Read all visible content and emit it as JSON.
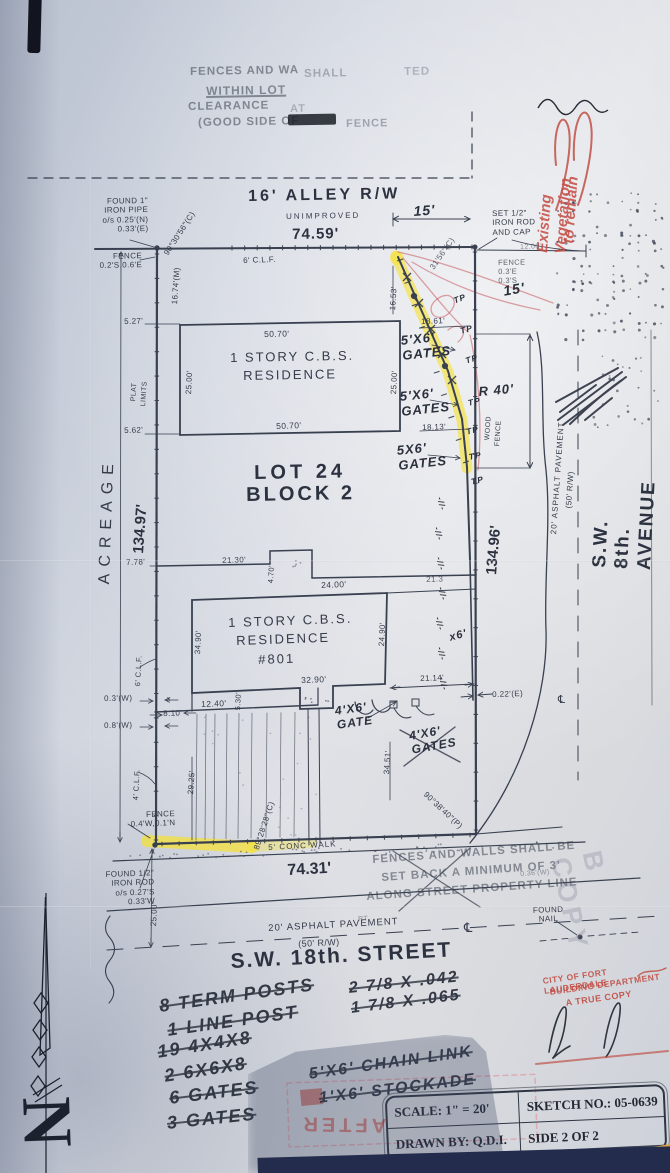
{
  "compass": {
    "letter": "N"
  },
  "title_block": {
    "scale": "SCALE: 1\" = 20'",
    "drawn_by": "DRAWN BY: Q.D.I.",
    "sketch_no": "SKETCH NO.: 05-0639",
    "side": "SIDE 2 OF 2"
  },
  "colors": {
    "paper": "#dfe1e6",
    "ink": "#394050",
    "highlight": "#f7e12d",
    "red_ink": "#c2463c",
    "shadow_navy": "#232c4c",
    "corner_orange": "#dfa245"
  },
  "labels": [
    {
      "n": "top-stamp-line1a",
      "t": "FENCES AND WA",
      "x": 190,
      "y": 66,
      "r": -1,
      "s": 11.5,
      "c": "stamp"
    },
    {
      "n": "top-stamp-line1b",
      "t": "SHALL",
      "x": 304,
      "y": 68,
      "r": -1,
      "s": 11.5,
      "c": "stamp",
      "o": 0.35
    },
    {
      "n": "top-stamp-line1c",
      "t": "TED",
      "x": 404,
      "y": 66,
      "r": -1,
      "s": 11.5,
      "c": "stamp",
      "o": 0.3
    },
    {
      "n": "top-stamp-line2",
      "t": "WITHIN LOT",
      "x": 206,
      "y": 84,
      "r": -1,
      "s": 12,
      "c": "stamp u"
    },
    {
      "n": "top-stamp-line3",
      "t": "CLEARANCE",
      "x": 188,
      "y": 101,
      "r": -1,
      "s": 11.5,
      "c": "stamp"
    },
    {
      "n": "top-stamp-line3b",
      "t": "AT",
      "x": 290,
      "y": 103,
      "r": -1,
      "s": 11,
      "c": "stamp",
      "o": 0.3
    },
    {
      "n": "top-stamp-line4a",
      "t": "(GOOD SIDE OF",
      "x": 198,
      "y": 117,
      "r": -1,
      "s": 11.5,
      "c": "stamp"
    },
    {
      "n": "top-stamp-line4b",
      "t": "FENCE",
      "x": 346,
      "y": 118,
      "r": -1,
      "s": 11,
      "c": "stamp",
      "o": 0.4
    },
    {
      "n": "red-note-existing-vegetation",
      "t": "Existing Vegetation",
      "x": 534,
      "y": 252,
      "r": -86,
      "s": 15,
      "c": "redhand"
    },
    {
      "n": "red-note-to-remain",
      "t": "to remain",
      "x": 560,
      "y": 243,
      "r": -86,
      "s": 15,
      "c": "redhand"
    },
    {
      "n": "alley-title",
      "t": "16' ALLEY R/W",
      "x": 248,
      "y": 188,
      "r": -1,
      "s": 16,
      "c": "big",
      "ls": 3
    },
    {
      "n": "alley-unimproved",
      "t": "UNIMPROVED",
      "x": 286,
      "y": 212,
      "r": -1,
      "s": 8,
      "c": "tech",
      "ls": 2
    },
    {
      "n": "alley-dim-7459",
      "t": "74.59'",
      "x": 292,
      "y": 226,
      "r": -1,
      "s": 15,
      "c": "big",
      "ls": 1
    },
    {
      "n": "found-pipe-note",
      "t": "FOUND 1\"\nIRON PIPE\no/s 0.25'(N)\n0.33'(E)",
      "x": 88,
      "y": 197,
      "r": -1,
      "s": 8,
      "c": "tech",
      "w": 60,
      "ta": "right"
    },
    {
      "n": "fence-note-nw",
      "t": "FENCE\n0.2'S,0.6'E",
      "x": 94,
      "y": 252,
      "r": -1,
      "s": 8,
      "c": "tech",
      "w": 48,
      "ta": "right"
    },
    {
      "n": "angle-nw",
      "t": "90°30'56\"(C)",
      "x": 162,
      "y": 252,
      "r": -57,
      "s": 8,
      "c": "tech"
    },
    {
      "n": "dim-1674",
      "t": "16.74'(M)",
      "x": 170,
      "y": 304,
      "r": -86,
      "s": 8,
      "c": "tech"
    },
    {
      "n": "clf-north",
      "t": "6' C.L.F.",
      "x": 243,
      "y": 256,
      "r": -2,
      "s": 8,
      "c": "tech"
    },
    {
      "n": "dim-15-alley",
      "t": "15'",
      "x": 413,
      "y": 203,
      "r": -4,
      "s": 14,
      "c": "hand"
    },
    {
      "n": "set-rod-note",
      "t": "SET 1/2\"\nIRON ROD\nAND CAP",
      "x": 492,
      "y": 209,
      "r": -1,
      "s": 8,
      "c": "tech"
    },
    {
      "n": "dim-1200",
      "t": "12.00'",
      "x": 520,
      "y": 244,
      "r": -2,
      "s": 7,
      "c": "tech",
      "o": 0.55
    },
    {
      "n": "fence-note-ne",
      "t": "FENCE\n0.3'E\n0.3'S",
      "x": 498,
      "y": 259,
      "r": -1,
      "s": 7.5,
      "c": "tech",
      "o": 0.8
    },
    {
      "n": "hand-15",
      "t": "15'",
      "x": 502,
      "y": 283,
      "r": -10,
      "s": 14,
      "c": "hand"
    },
    {
      "n": "angle-ne",
      "t": "31'56\"(C)",
      "x": 428,
      "y": 266,
      "r": -55,
      "s": 8,
      "c": "tech",
      "o": 0.8
    },
    {
      "n": "dim-1653",
      "t": "16.53'",
      "x": 388,
      "y": 310,
      "r": -86,
      "s": 8,
      "c": "tech"
    },
    {
      "n": "dim-1861",
      "t": "18.61'",
      "x": 421,
      "y": 317,
      "r": -2,
      "s": 8,
      "c": "tech"
    },
    {
      "n": "gate-label-1",
      "t": "5'X6'\nGATES",
      "x": 400,
      "y": 333,
      "r": -6,
      "s": 13,
      "c": "hand"
    },
    {
      "n": "gate-label-2",
      "t": "5'X6'\nGATES",
      "x": 399,
      "y": 389,
      "r": -6,
      "s": 13,
      "c": "hand"
    },
    {
      "n": "gate-label-3",
      "t": "5X6'\nGATES",
      "x": 396,
      "y": 443,
      "r": -6,
      "s": 13,
      "c": "hand"
    },
    {
      "n": "hand-r40",
      "t": "R 40'",
      "x": 478,
      "y": 384,
      "r": -5,
      "s": 13,
      "c": "hand"
    },
    {
      "n": "wood-fence-label-1",
      "t": "WOOD",
      "x": 484,
      "y": 440,
      "r": -86,
      "s": 7,
      "c": "tech"
    },
    {
      "n": "wood-fence-label-2",
      "t": "FENCE",
      "x": 494,
      "y": 446,
      "r": -86,
      "s": 7,
      "c": "tech"
    },
    {
      "n": "dim-1813",
      "t": "18.13'",
      "x": 422,
      "y": 423,
      "r": -2,
      "s": 8,
      "c": "tech"
    },
    {
      "n": "tp-mark-a",
      "t": "TP",
      "x": 452,
      "y": 296,
      "r": -20,
      "s": 8.5,
      "c": "hand"
    },
    {
      "n": "tp-mark-b",
      "t": "TP",
      "x": 459,
      "y": 326,
      "r": -15,
      "s": 8.5,
      "c": "hand"
    },
    {
      "n": "tp-mark-c",
      "t": "TP",
      "x": 464,
      "y": 356,
      "r": -18,
      "s": 8.5,
      "c": "hand"
    },
    {
      "n": "tp-mark-d",
      "t": "TP",
      "x": 467,
      "y": 398,
      "r": -12,
      "s": 8.5,
      "c": "hand"
    },
    {
      "n": "tp-mark-e",
      "t": "TP",
      "x": 465,
      "y": 427,
      "r": -15,
      "s": 8.5,
      "c": "hand"
    },
    {
      "n": "tp-mark-f",
      "t": "TP",
      "x": 468,
      "y": 452,
      "r": -10,
      "s": 8.5,
      "c": "hand"
    },
    {
      "n": "tp-mark-g",
      "t": "TP",
      "x": 470,
      "y": 477,
      "r": -14,
      "s": 8.5,
      "c": "hand"
    },
    {
      "n": "avenue-name",
      "t": "S.W. 8th. AVENUE",
      "x": 589,
      "y": 567,
      "r": -87,
      "s": 19,
      "c": "big",
      "ls": 2
    },
    {
      "n": "avenue-pavement",
      "t": "20' ASPHALT PAVEMENT",
      "x": 549,
      "y": 534,
      "r": -86,
      "s": 8,
      "c": "tech",
      "ls": 1
    },
    {
      "n": "avenue-rw",
      "t": "(50' R/W)",
      "x": 564,
      "y": 508,
      "r": -86,
      "s": 8,
      "c": "tech"
    },
    {
      "n": "dim-13496",
      "t": "134.96'",
      "x": 483,
      "y": 574,
      "r": -85,
      "s": 15,
      "c": "big"
    },
    {
      "n": "dim-022e",
      "t": "0.22'(E)",
      "x": 492,
      "y": 690,
      "r": -2,
      "s": 8,
      "c": "tech"
    },
    {
      "n": "dim-2114",
      "t": "21.14'",
      "x": 420,
      "y": 674,
      "r": -2,
      "s": 8,
      "c": "tech"
    },
    {
      "n": "hand-x6",
      "t": "x6'",
      "x": 448,
      "y": 632,
      "r": -15,
      "s": 11,
      "c": "hand"
    },
    {
      "n": "hash-mark-1",
      "t": "-//-",
      "x": 444,
      "y": 496,
      "r": 75,
      "s": 8,
      "c": "hand"
    },
    {
      "n": "hash-mark-2",
      "t": "-//-",
      "x": 441,
      "y": 526,
      "r": 75,
      "s": 8,
      "c": "hand"
    },
    {
      "n": "hash-mark-3",
      "t": "-//-",
      "x": 443,
      "y": 556,
      "r": 75,
      "s": 8,
      "c": "hand"
    },
    {
      "n": "hash-mark-4",
      "t": "-//-",
      "x": 445,
      "y": 586,
      "r": 75,
      "s": 8,
      "c": "hand"
    },
    {
      "n": "hash-mark-5",
      "t": "-//-",
      "x": 442,
      "y": 616,
      "r": 75,
      "s": 8,
      "c": "hand"
    },
    {
      "n": "hash-mark-6",
      "t": "-//-",
      "x": 444,
      "y": 646,
      "r": 75,
      "s": 8,
      "c": "hand"
    },
    {
      "n": "hash-mark-7",
      "t": "-//-",
      "x": 446,
      "y": 676,
      "r": 75,
      "s": 8,
      "c": "hand"
    },
    {
      "n": "lot-title",
      "t": "LOT 24",
      "x": 254,
      "y": 462,
      "r": -1,
      "s": 20,
      "c": "big",
      "ls": 4
    },
    {
      "n": "block-title",
      "t": "BLOCK 2",
      "x": 246,
      "y": 484,
      "r": -1,
      "s": 20,
      "c": "big",
      "ls": 3
    },
    {
      "n": "acreage-label",
      "t": "ACREAGE",
      "x": 96,
      "y": 584,
      "r": -88,
      "s": 16,
      "c": "tech",
      "ls": 7
    },
    {
      "n": "dim-13497",
      "t": "134.97'",
      "x": 130,
      "y": 553,
      "r": -86,
      "s": 15,
      "c": "big"
    },
    {
      "n": "plat-label",
      "t": "PLAT",
      "x": 130,
      "y": 401,
      "r": -86,
      "s": 7,
      "c": "tech"
    },
    {
      "n": "limits-label",
      "t": "LIMITS",
      "x": 140,
      "y": 406,
      "r": -86,
      "s": 7,
      "c": "tech"
    },
    {
      "n": "dim-527",
      "t": "5.27'",
      "x": 124,
      "y": 317,
      "r": -2,
      "s": 8,
      "c": "tech"
    },
    {
      "n": "dim-562",
      "t": "5.62'",
      "x": 124,
      "y": 426,
      "r": -2,
      "s": 8,
      "c": "tech"
    },
    {
      "n": "dim-778",
      "t": "7.78'",
      "x": 126,
      "y": 558,
      "r": -2,
      "s": 8,
      "c": "tech"
    },
    {
      "n": "res1-dim-top",
      "t": "50.70'",
      "x": 264,
      "y": 329,
      "r": -1,
      "s": 8.5,
      "c": "tech"
    },
    {
      "n": "res1-name-1",
      "t": "1 STORY C.B.S.",
      "x": 230,
      "y": 350,
      "r": -1,
      "s": 13,
      "c": "tech",
      "ls": 2
    },
    {
      "n": "res1-name-2",
      "t": "RESIDENCE",
      "x": 243,
      "y": 368,
      "r": -1,
      "s": 13,
      "c": "tech",
      "ls": 2
    },
    {
      "n": "res1-dim-left",
      "t": "25.00'",
      "x": 184,
      "y": 394,
      "r": -87,
      "s": 8,
      "c": "tech"
    },
    {
      "n": "res1-dim-right",
      "t": "25.00'",
      "x": 389,
      "y": 394,
      "r": -87,
      "s": 8,
      "c": "tech"
    },
    {
      "n": "res1-dim-bottom",
      "t": "50.70'",
      "x": 276,
      "y": 421,
      "r": -2,
      "s": 8.5,
      "c": "tech"
    },
    {
      "n": "dim-2130",
      "t": "21.30'",
      "x": 222,
      "y": 556,
      "r": -2,
      "s": 8,
      "c": "tech"
    },
    {
      "n": "dim-470",
      "t": "4.70'",
      "x": 267,
      "y": 583,
      "r": -87,
      "s": 7.5,
      "c": "tech"
    },
    {
      "n": "dim-2400",
      "t": "24.00'",
      "x": 321,
      "y": 580,
      "r": -2,
      "s": 8.5,
      "c": "tech"
    },
    {
      "n": "dim-213",
      "t": "21.3",
      "x": 426,
      "y": 575,
      "r": -2,
      "s": 8,
      "c": "tech",
      "o": 0.8
    },
    {
      "n": "res2-name-1",
      "t": "1 STORY C.B.S.",
      "x": 228,
      "y": 615,
      "r": -2,
      "s": 13,
      "c": "tech",
      "ls": 2
    },
    {
      "n": "res2-name-2",
      "t": "RESIDENCE",
      "x": 236,
      "y": 633,
      "r": -2,
      "s": 13,
      "c": "tech",
      "ls": 2
    },
    {
      "n": "res2-number",
      "t": "#801",
      "x": 258,
      "y": 652,
      "r": -2,
      "s": 13,
      "c": "tech",
      "ls": 2
    },
    {
      "n": "res2-dim-left",
      "t": "34.90'",
      "x": 193,
      "y": 654,
      "r": -87,
      "s": 8,
      "c": "tech"
    },
    {
      "n": "res2-dim-right",
      "t": "24.90'",
      "x": 377,
      "y": 646,
      "r": -87,
      "s": 8,
      "c": "tech"
    },
    {
      "n": "res2-dim-bottom",
      "t": "32.90'",
      "x": 301,
      "y": 675,
      "r": -2,
      "s": 8.5,
      "c": "tech"
    },
    {
      "n": "dim-530",
      "t": "5.30'",
      "x": 234,
      "y": 710,
      "r": -87,
      "s": 7.5,
      "c": "tech"
    },
    {
      "n": "dim-1240",
      "t": "12.40'",
      "x": 201,
      "y": 699,
      "r": -2,
      "s": 8.5,
      "c": "tech"
    },
    {
      "n": "x-mark",
      "t": "x",
      "x": 167,
      "y": 696,
      "r": 0,
      "s": 7,
      "c": "tech"
    },
    {
      "n": "dim-810",
      "t": "8.10'",
      "x": 163,
      "y": 709,
      "r": -2,
      "s": 8,
      "c": "tech"
    },
    {
      "n": "dim-03w",
      "t": "0.3'(W)",
      "x": 104,
      "y": 694,
      "r": -1,
      "s": 8,
      "c": "tech"
    },
    {
      "n": "dim-08w",
      "t": "0.8'(W)",
      "x": 104,
      "y": 721,
      "r": -1,
      "s": 8,
      "c": "tech"
    },
    {
      "n": "clf-6-left",
      "t": "6' C.L.F.",
      "x": 134,
      "y": 686,
      "r": -87,
      "s": 7.5,
      "c": "tech"
    },
    {
      "n": "clf-4-left",
      "t": "4' C.L.F.",
      "x": 132,
      "y": 800,
      "r": -87,
      "s": 7.5,
      "c": "tech"
    },
    {
      "n": "dim-2925",
      "t": "29.25'",
      "x": 186,
      "y": 794,
      "r": -86,
      "s": 8,
      "c": "tech"
    },
    {
      "n": "angle-sw",
      "t": "89°28'28\"(C)",
      "x": 252,
      "y": 848,
      "r": -72,
      "s": 8,
      "c": "tech"
    },
    {
      "n": "gate-label-4",
      "t": "4'X6'\nGATE",
      "x": 334,
      "y": 704,
      "r": -8,
      "s": 12,
      "c": "hand"
    },
    {
      "n": "gate-label-5",
      "t": "4'X6'\nGATES",
      "x": 408,
      "y": 729,
      "r": -10,
      "s": 12,
      "c": "hand"
    },
    {
      "n": "dim-3451",
      "t": "34.51'",
      "x": 382,
      "y": 774,
      "r": -86,
      "s": 8,
      "c": "tech"
    },
    {
      "n": "angle-se",
      "t": "90°38'40\"(P)",
      "x": 428,
      "y": 790,
      "r": 43,
      "s": 8,
      "c": "tech"
    },
    {
      "n": "fence-note-sw",
      "t": "FENCE\n0.4'W,0.1'N",
      "x": 90,
      "y": 812,
      "r": -2,
      "s": 8,
      "c": "tech",
      "w": 85,
      "ta": "right"
    },
    {
      "n": "conc-walk-label",
      "t": "5' CONC WALK",
      "x": 268,
      "y": 843,
      "r": -3,
      "s": 8,
      "c": "tech",
      "ls": 1
    },
    {
      "n": "dim-7431",
      "t": "74.31'",
      "x": 287,
      "y": 862,
      "r": -3,
      "s": 16,
      "c": "big"
    },
    {
      "n": "found-rod-note",
      "t": "FOUND 1/2\"\nIRON ROD\no/s 0.27'S\n0.33'W",
      "x": 76,
      "y": 871,
      "r": -2,
      "s": 8,
      "c": "tech",
      "w": 78,
      "ta": "right"
    },
    {
      "n": "dim-2500",
      "t": "25.00'",
      "x": 149,
      "y": 926,
      "r": -87,
      "s": 8,
      "c": "tech"
    },
    {
      "n": "street-pavement",
      "t": "20' ASPHALT PAVEMENT",
      "x": 268,
      "y": 923,
      "r": -3,
      "s": 9.5,
      "c": "tech",
      "ls": 1
    },
    {
      "n": "street-rw",
      "t": "(50' R/W)",
      "x": 298,
      "y": 939,
      "r": -3,
      "s": 9,
      "c": "tech"
    },
    {
      "n": "street-name",
      "t": "S.W. 18th. STREET",
      "x": 230,
      "y": 950,
      "r": -3,
      "s": 21,
      "c": "big",
      "ls": 2
    },
    {
      "n": "setback-stamp-l1",
      "t": "FENCES AND WALLS SHALL BE",
      "x": 372,
      "y": 854,
      "r": -4,
      "s": 11.5,
      "c": "stamp"
    },
    {
      "n": "setback-stamp-l2",
      "t": "SET BACK A MINIMUM OF 3'",
      "x": 381,
      "y": 872,
      "r": -4,
      "s": 11.5,
      "c": "stamp"
    },
    {
      "n": "setback-stamp-l3",
      "t": "ALONG STREET PROPERTY LINE",
      "x": 366,
      "y": 891,
      "r": -4,
      "s": 11.5,
      "c": "stamp"
    },
    {
      "n": "faint-036w",
      "t": "0.36'(W)",
      "x": 520,
      "y": 871,
      "r": -4,
      "s": 7,
      "c": "tech",
      "o": 0.5
    },
    {
      "n": "found-nail-note",
      "t": "FOUND\nNAIL",
      "x": 528,
      "y": 906,
      "r": -2,
      "s": 8,
      "c": "tech",
      "w": 40,
      "ta": "center"
    },
    {
      "n": "centerline-street",
      "t": "℄",
      "x": 464,
      "y": 920,
      "r": 0,
      "s": 13,
      "c": "tech"
    },
    {
      "n": "centerline-avenue",
      "t": "℄",
      "x": 558,
      "y": 694,
      "r": 0,
      "s": 11,
      "c": "tech"
    },
    {
      "n": "watermark-copy",
      "t": "B COPY",
      "x": 606,
      "y": 848,
      "r": 78,
      "s": 27,
      "c": "wm",
      "ls": 5
    },
    {
      "n": "frag-rt",
      "t": "RT",
      "x": 358,
      "y": 916,
      "r": -3,
      "s": 7,
      "c": "tech",
      "o": 0.5
    },
    {
      "n": "note-term-posts",
      "t": "8 TERM POSTS",
      "x": 158,
      "y": 996,
      "r": -8,
      "s": 18,
      "c": "hand2 struck"
    },
    {
      "n": "note-line-post",
      "t": "1 LINE POST",
      "x": 166,
      "y": 1020,
      "r": -8,
      "s": 18,
      "c": "hand2 struck"
    },
    {
      "n": "note-19-4x4x8",
      "t": "19 4X4X8",
      "x": 156,
      "y": 1042,
      "r": -9,
      "s": 18,
      "c": "hand2 struck"
    },
    {
      "n": "note-2-6x6x8",
      "t": "2 6X6X8",
      "x": 163,
      "y": 1066,
      "r": -9,
      "s": 18,
      "c": "hand2 struck"
    },
    {
      "n": "note-6-gates",
      "t": "6 GATES",
      "x": 168,
      "y": 1088,
      "r": -7,
      "s": 18,
      "c": "hand2 struck"
    },
    {
      "n": "note-3-gates",
      "t": "3 GATES",
      "x": 166,
      "y": 1113,
      "r": -6,
      "s": 18,
      "c": "hand2 struck"
    },
    {
      "n": "note-278-042",
      "t": "2 7/8 X .042",
      "x": 348,
      "y": 980,
      "r": -6,
      "s": 16,
      "c": "hand2 struck"
    },
    {
      "n": "note-178-065",
      "t": "1 7/8 X .065",
      "x": 350,
      "y": 1000,
      "r": -7,
      "s": 16,
      "c": "hand2 struck"
    },
    {
      "n": "note-chain-link",
      "t": "5'X6' CHAIN LINK",
      "x": 308,
      "y": 1066,
      "r": -8,
      "s": 16,
      "c": "hand2 struck"
    },
    {
      "n": "note-stockade",
      "t": "1'X6' STOCKADE",
      "x": 318,
      "y": 1090,
      "r": -7,
      "s": 16,
      "c": "hand2 struck"
    },
    {
      "n": "after-stamp",
      "t": "AFTER",
      "x": 386,
      "y": 1136,
      "r": 181,
      "s": 20,
      "c": "redstamp",
      "ls": 4
    },
    {
      "n": "city-stamp-l1",
      "t": "CITY OF FORT LAUDERDALE",
      "x": 542,
      "y": 976,
      "r": -8,
      "s": 8.5,
      "c": "red"
    },
    {
      "n": "city-stamp-l2",
      "t": "BUILDING DEPARTMENT",
      "x": 549,
      "y": 987,
      "r": -8,
      "s": 8.5,
      "c": "red"
    },
    {
      "n": "city-stamp-l3",
      "t": "A TRUE COPY",
      "x": 565,
      "y": 998,
      "r": -8,
      "s": 9,
      "c": "red"
    }
  ]
}
